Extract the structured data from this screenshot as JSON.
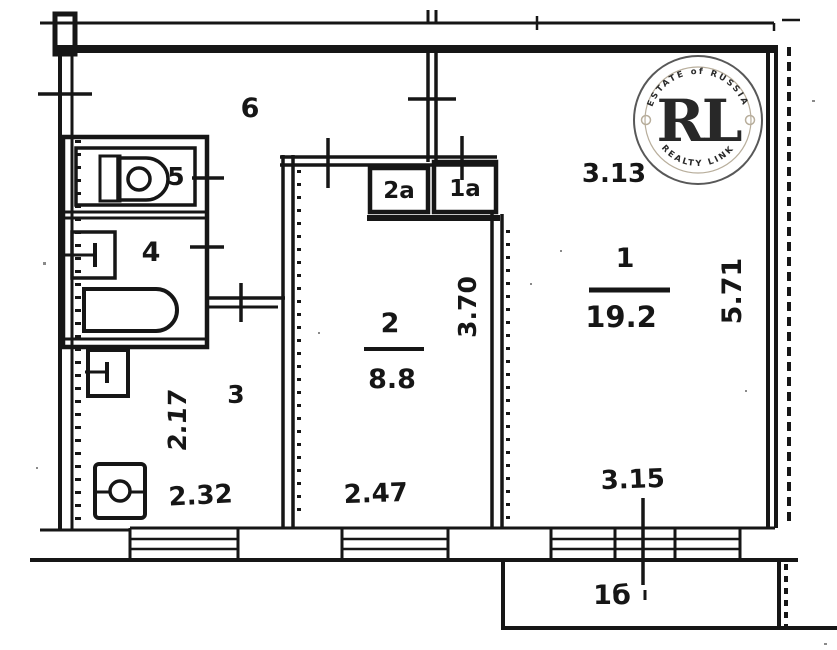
{
  "plan": {
    "background": "#ffffff",
    "ink": "#161616",
    "rooms": {
      "room1": {
        "label": "1",
        "area": "19.2"
      },
      "room2": {
        "label": "2",
        "area": "8.8"
      },
      "kitchen": {
        "label": "3"
      },
      "bathroom": {
        "label": "4"
      },
      "wc": {
        "label": "5"
      },
      "hall": {
        "label": "6"
      },
      "closet2a": {
        "label": "2а"
      },
      "closet1a": {
        "label": "1а"
      },
      "balcony": {
        "label": "1б"
      }
    },
    "dimensions": {
      "room1_top": "3.13",
      "room1_right": "5.71",
      "room1_bottom": "3.15",
      "room2_right": "3.70",
      "room2_bottom": "2.47",
      "kitchen_left": "2.17",
      "kitchen_bottom": "2.32"
    },
    "watermark": {
      "arc_top": "ESTATE of RUSSIA",
      "monogram": "RL",
      "arc_bottom": "REALTY LINK",
      "gold_dark": "#9a701d",
      "gold_mid": "#c3922f",
      "gold_light": "#e0ba60",
      "ring": "#4a4a4a",
      "arc_text": "#b3a894"
    }
  }
}
